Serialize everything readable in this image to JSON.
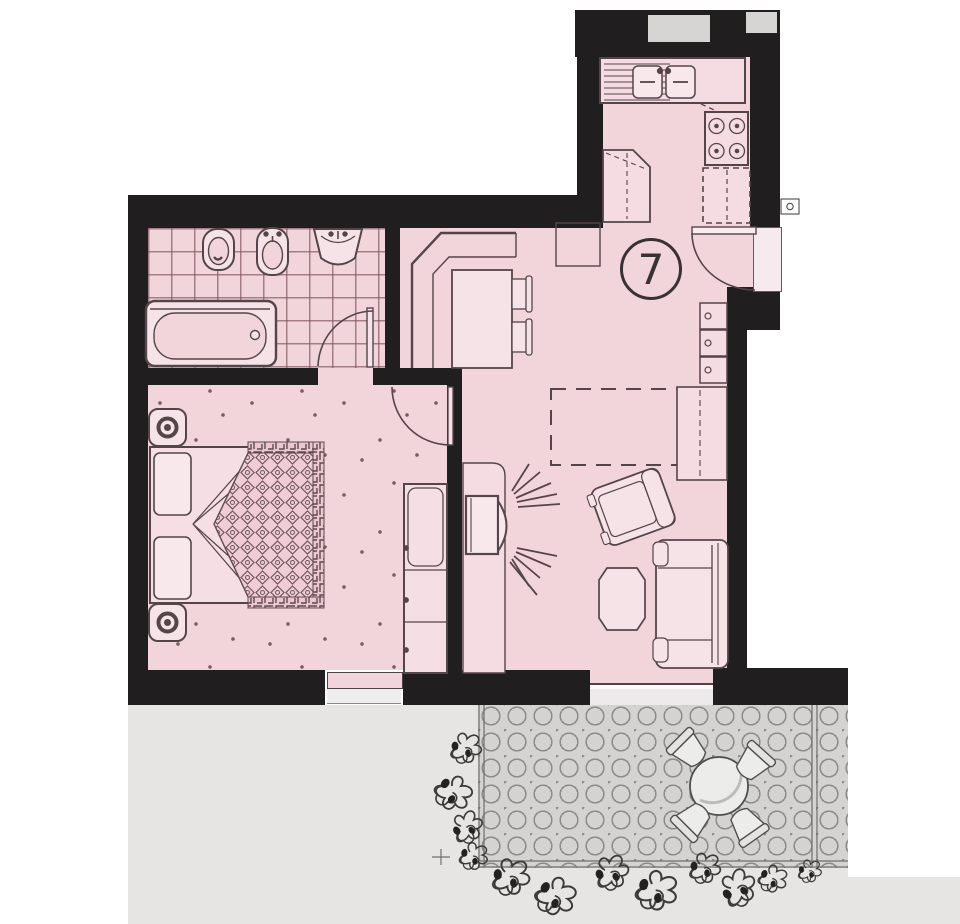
{
  "unit": {
    "number": "7"
  },
  "plan": {
    "type": "apartment-floor-plan",
    "rooms": [
      "bathroom",
      "bedroom",
      "hall-with-dining-nook",
      "kitchen",
      "living-room",
      "terrace"
    ],
    "fixtures": [
      "toilet",
      "bidet",
      "washbasin",
      "bathtub",
      "bathroom-door",
      "double-bed",
      "pillows",
      "patterned-quilt",
      "nightstand",
      "wardrobe",
      "bedroom-door",
      "corner-bench",
      "dining-table",
      "chairs",
      "kitchen-counter-with-double-sink",
      "stove-4-burners",
      "refrigerator-dashed",
      "tall-cabinet",
      "entry-door",
      "doorbell-panel",
      "shelf-unit",
      "planned-table-dashed",
      "sideboard",
      "tv-on-sideboard",
      "tv-signal-rays",
      "armchair",
      "coffee-table",
      "sofa",
      "terrace-round-table",
      "terrace-chairs",
      "shrubs-planting",
      "octagonal-paving",
      "windows",
      "glass-terrace-door"
    ]
  },
  "palette": {
    "floor_pink": "#f2d5db",
    "wall_black": "#211e1f",
    "line_brown": "#54454a",
    "tile_line": "#82525f",
    "ground_gray": "#e6e5e4",
    "paving_gray": "#d4d3d2",
    "window_gray": "#d6d5d4",
    "furniture_fill": "#f6e3e8",
    "white": "#ffffff"
  }
}
